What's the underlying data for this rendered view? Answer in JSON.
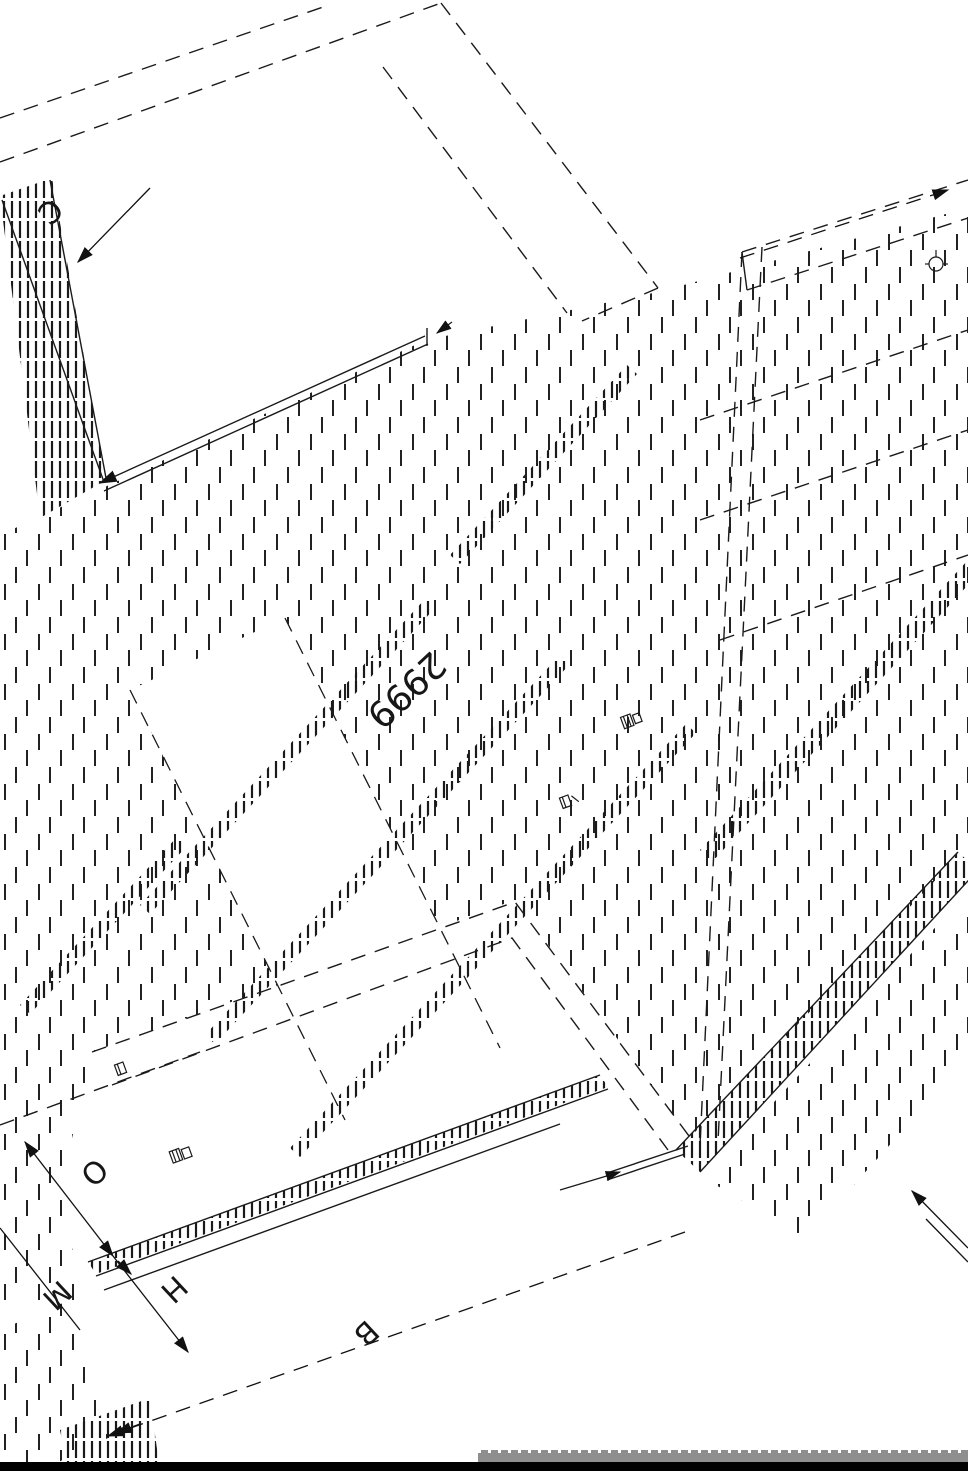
{
  "drawing": {
    "type": "isometric cabinet assembly technical drawing, sectioned panels with hatching",
    "dimension_main": "2999",
    "labels": {
      "c": "C",
      "o": "O",
      "m": "M",
      "h": "H",
      "b": "B"
    }
  },
  "colors": {
    "background": "#ffffff",
    "line": "#1a1a1a",
    "hatch": "#222222",
    "bottom_strip_black": "#000000",
    "title_strip_gray": "#8e8e8e"
  }
}
